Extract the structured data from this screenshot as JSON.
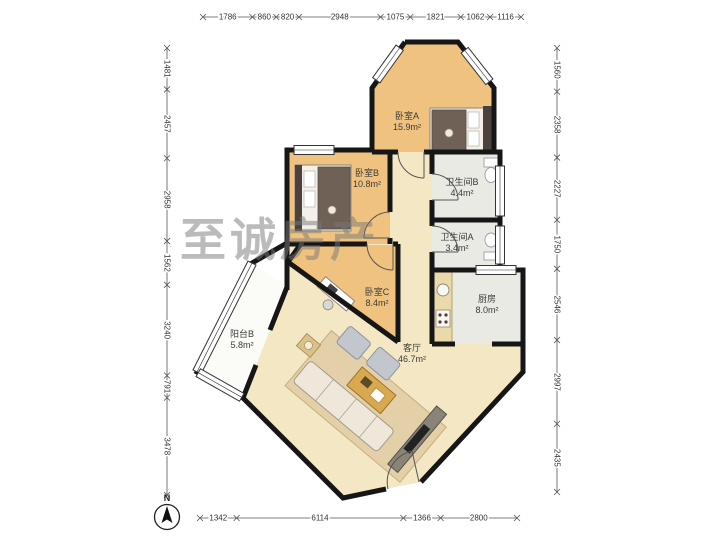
{
  "watermark": "至诚房产",
  "compass": {
    "label": "N"
  },
  "rooms": [
    {
      "id": "bedroom-a",
      "name": "卧室A",
      "area": "15.9m²"
    },
    {
      "id": "bedroom-b",
      "name": "卧室B",
      "area": "10.8m²"
    },
    {
      "id": "bedroom-c",
      "name": "卧室C",
      "area": "8.4m²"
    },
    {
      "id": "bathroom-b",
      "name": "卫生间B",
      "area": "4.4m²"
    },
    {
      "id": "bathroom-a",
      "name": "卫生间A",
      "area": "3.4m²"
    },
    {
      "id": "kitchen",
      "name": "厨房",
      "area": "8.0m²"
    },
    {
      "id": "balcony-b",
      "name": "阳台B",
      "area": "5.8m²"
    },
    {
      "id": "living-room",
      "name": "客厅",
      "area": "46.7m²"
    }
  ],
  "dimensions_mm": {
    "top": [
      1786,
      860,
      820,
      2948,
      1075,
      1821,
      1062,
      1116
    ],
    "bottom": [
      1342,
      6114,
      1366,
      2800
    ],
    "left": [
      1481,
      2457,
      2958,
      1562,
      3240,
      791,
      3478
    ],
    "right": [
      1560,
      2358,
      2227,
      1750,
      2546,
      2997,
      2435
    ]
  },
  "colors": {
    "wall": "#161616",
    "wood_floor": "#f0c27f",
    "living_floor": "#f4e8c4",
    "tile_floor": "#eaeae5",
    "balcony_floor": "#fbfbf8",
    "dimension_text": "#333333",
    "watermark_gray": "#787878",
    "table_wood": "#d8a94f"
  }
}
